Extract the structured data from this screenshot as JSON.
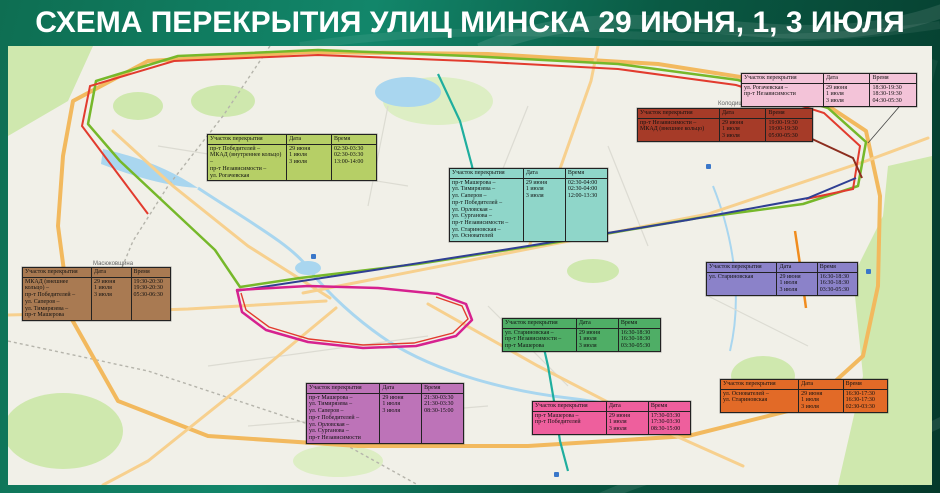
{
  "title": "СХЕМА ПЕРЕКРЫТИЯ УЛИЦ МИНСКА 29 ИЮНЯ, 1, 3 ИЮЛЯ",
  "table_headers": {
    "section": "Участок перекрытия",
    "date": "Дата",
    "time": "Время"
  },
  "dates": [
    "29 июня",
    "1 июля",
    "3 июля"
  ],
  "closures": [
    {
      "bg": "#b6cf66",
      "streets": [
        "пр-т Победителей –",
        "МКАД (внутреннее кольцо) –",
        "пр-т Независимости –",
        "ул. Рогачевская"
      ],
      "times": [
        "02:30-03:30",
        "02:30-03:30",
        "13:00-14:00"
      ]
    },
    {
      "bg": "#8fd6c9",
      "streets": [
        "пр-т Машерова –",
        "ул. Тимирязева –",
        "ул. Саперов –",
        "пр-т Победителей –",
        "ул. Орловская –",
        "ул. Сурганова –",
        "пр-т Независимости –",
        "ул. Стариновская –",
        "ул. Основателей"
      ],
      "times": [
        "02:30-04:00",
        "02:30-04:00",
        "12:00-13:30"
      ]
    },
    {
      "bg": "#f3c3d8",
      "streets": [
        "ул. Рогачевская –",
        "пр-т Независимости"
      ],
      "times": [
        "18:30-19:30",
        "18:30-19:30",
        "04:30-05:30"
      ]
    },
    {
      "bg": "#a63b28",
      "streets": [
        "пр-т Независимости –",
        "МКАД (внешнее кольцо)"
      ],
      "times": [
        "19:00-19:30",
        "19:00-19:30",
        "05:00-05:30"
      ]
    },
    {
      "bg": "#a97a52",
      "streets": [
        "МКАД (внешнее кольцо) –",
        "пр-т Победителей –",
        "ул. Саперов –",
        "ул. Тимирязева –",
        "пр-т Машерова"
      ],
      "times": [
        "19:30-20:30",
        "19:30-20:30",
        "05:30-06:30"
      ]
    },
    {
      "bg": "#8b82c9",
      "streets": [
        "ул. Стариновская"
      ],
      "times": [
        "16:30-18:30",
        "16:30-18:30",
        "03:30-05:30"
      ]
    },
    {
      "bg": "#4fae66",
      "streets": [
        "ул. Стариновская –",
        "пр-т Независимости –",
        "пр-т Машерова"
      ],
      "times": [
        "16:30-18:30",
        "16:30-18:30",
        "03:30-05:30"
      ]
    },
    {
      "bg": "#bd73b8",
      "streets": [
        "пр-т Машерова –",
        "ул. Тимирязева –",
        "ул. Саперов –",
        "пр-т Победителей –",
        "ул. Орловская –",
        "ул. Сурганова –",
        "пр-т Независимости"
      ],
      "times": [
        "21:30-03:30",
        "21:30-03:30",
        "08:30-15:00"
      ]
    },
    {
      "bg": "#ee5f9d",
      "streets": [
        "пр-т Машерова –",
        "пр-т Победителей"
      ],
      "times": [
        "17:30-03:30",
        "17:30-03:30",
        "08:30-15:00"
      ]
    },
    {
      "bg": "#e26a27",
      "streets": [
        "ул. Основателей –",
        "ул. Стариновская"
      ],
      "times": [
        "16:30-17:30",
        "16:30-17:30",
        "02:30-03:30"
      ]
    }
  ],
  "map_labels": [
    "Колодищи",
    "Масюковщина"
  ],
  "route_colors": {
    "green": "#76b82a",
    "red": "#e23b2e",
    "navy": "#2f3f93",
    "magenta": "#d6218f",
    "teal": "#1fae9e",
    "orange": "#f08c1e",
    "darkred": "#8c2d1e"
  }
}
